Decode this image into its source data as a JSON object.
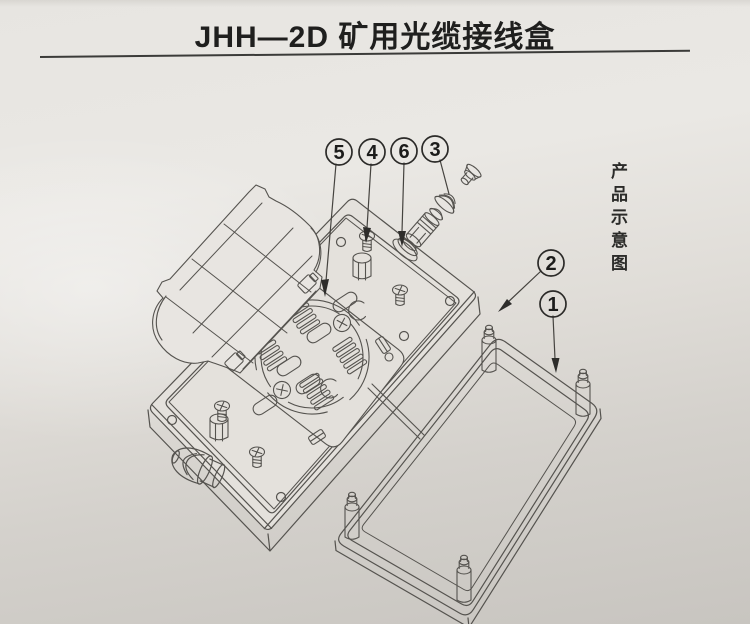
{
  "document": {
    "title": "JHH—2D 矿用光缆接线盒",
    "side_caption": "产品示意图",
    "callouts": [
      {
        "number": "5"
      },
      {
        "number": "4"
      },
      {
        "number": "6"
      },
      {
        "number": "3"
      },
      {
        "number": "2"
      },
      {
        "number": "1"
      }
    ],
    "colors": {
      "paper_top": "#eae8e5",
      "paper_bottom": "#c9c6c1",
      "line": "#55534f",
      "line_dark": "#3b3b39",
      "text": "#1f1f1e",
      "arrow": "#2e2d2b"
    }
  }
}
